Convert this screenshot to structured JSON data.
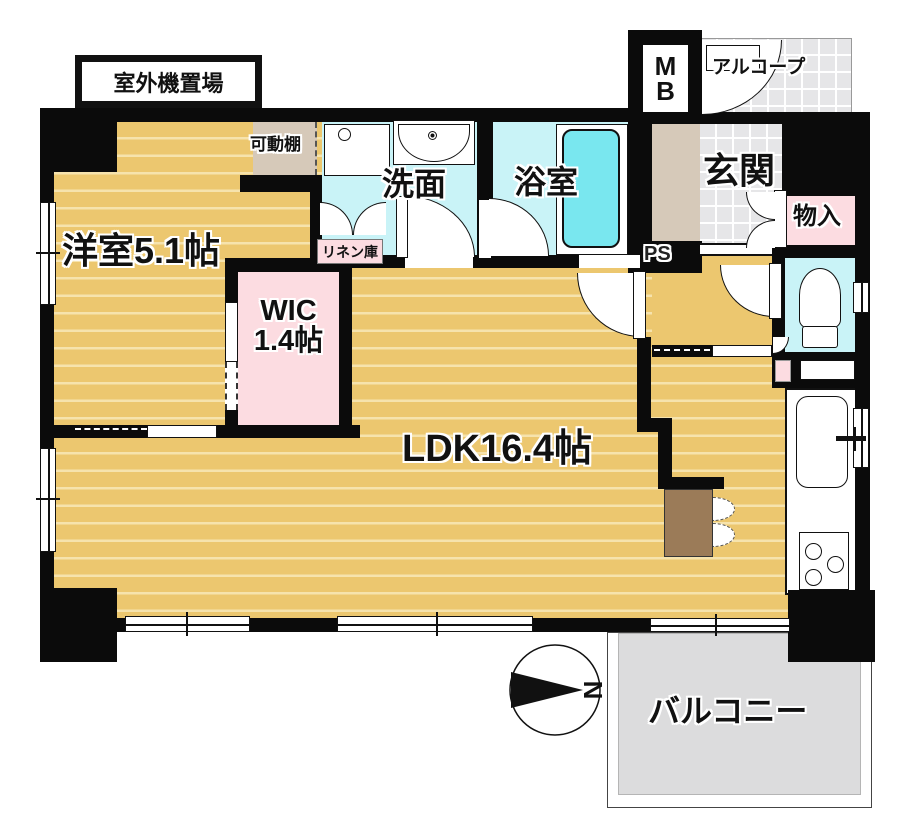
{
  "plan": {
    "type": "apartment-floorplan",
    "rooms": {
      "western": {
        "label": "洋室5.1帖"
      },
      "wic": {
        "line1": "WIC",
        "line2": "1.4帖"
      },
      "ldk": {
        "label": "LDK16.4帖"
      },
      "washroom": {
        "label": "洗面"
      },
      "bathroom": {
        "label": "浴室"
      },
      "entrance": {
        "label": "玄関"
      },
      "storage": {
        "label": "物入"
      },
      "balcony": {
        "label": "バルコニー"
      },
      "alcove": {
        "label": "アルコープ"
      },
      "linen": {
        "label": "リネン庫"
      },
      "movable_shelf": {
        "label": "可動棚"
      },
      "meter_box": {
        "line1": "M",
        "line2": "B"
      },
      "pipe_space": {
        "label": "PS"
      },
      "outdoor_unit": {
        "label": "室外機置場"
      }
    },
    "compass": {
      "label": "N"
    },
    "colors": {
      "floor_wood": "#ecc76f",
      "wet_room_cyan": "#c9f3f7",
      "bathtub_cyan": "#79e7ef",
      "closet_pink": "#fcdce1",
      "tile_gray": "#e6e6e8",
      "balcony_gray": "#dcdcdd",
      "shelf_beige": "#d6c9b9",
      "counter_brown": "#9b7b58",
      "wall_black": "#0b0b0b"
    }
  }
}
